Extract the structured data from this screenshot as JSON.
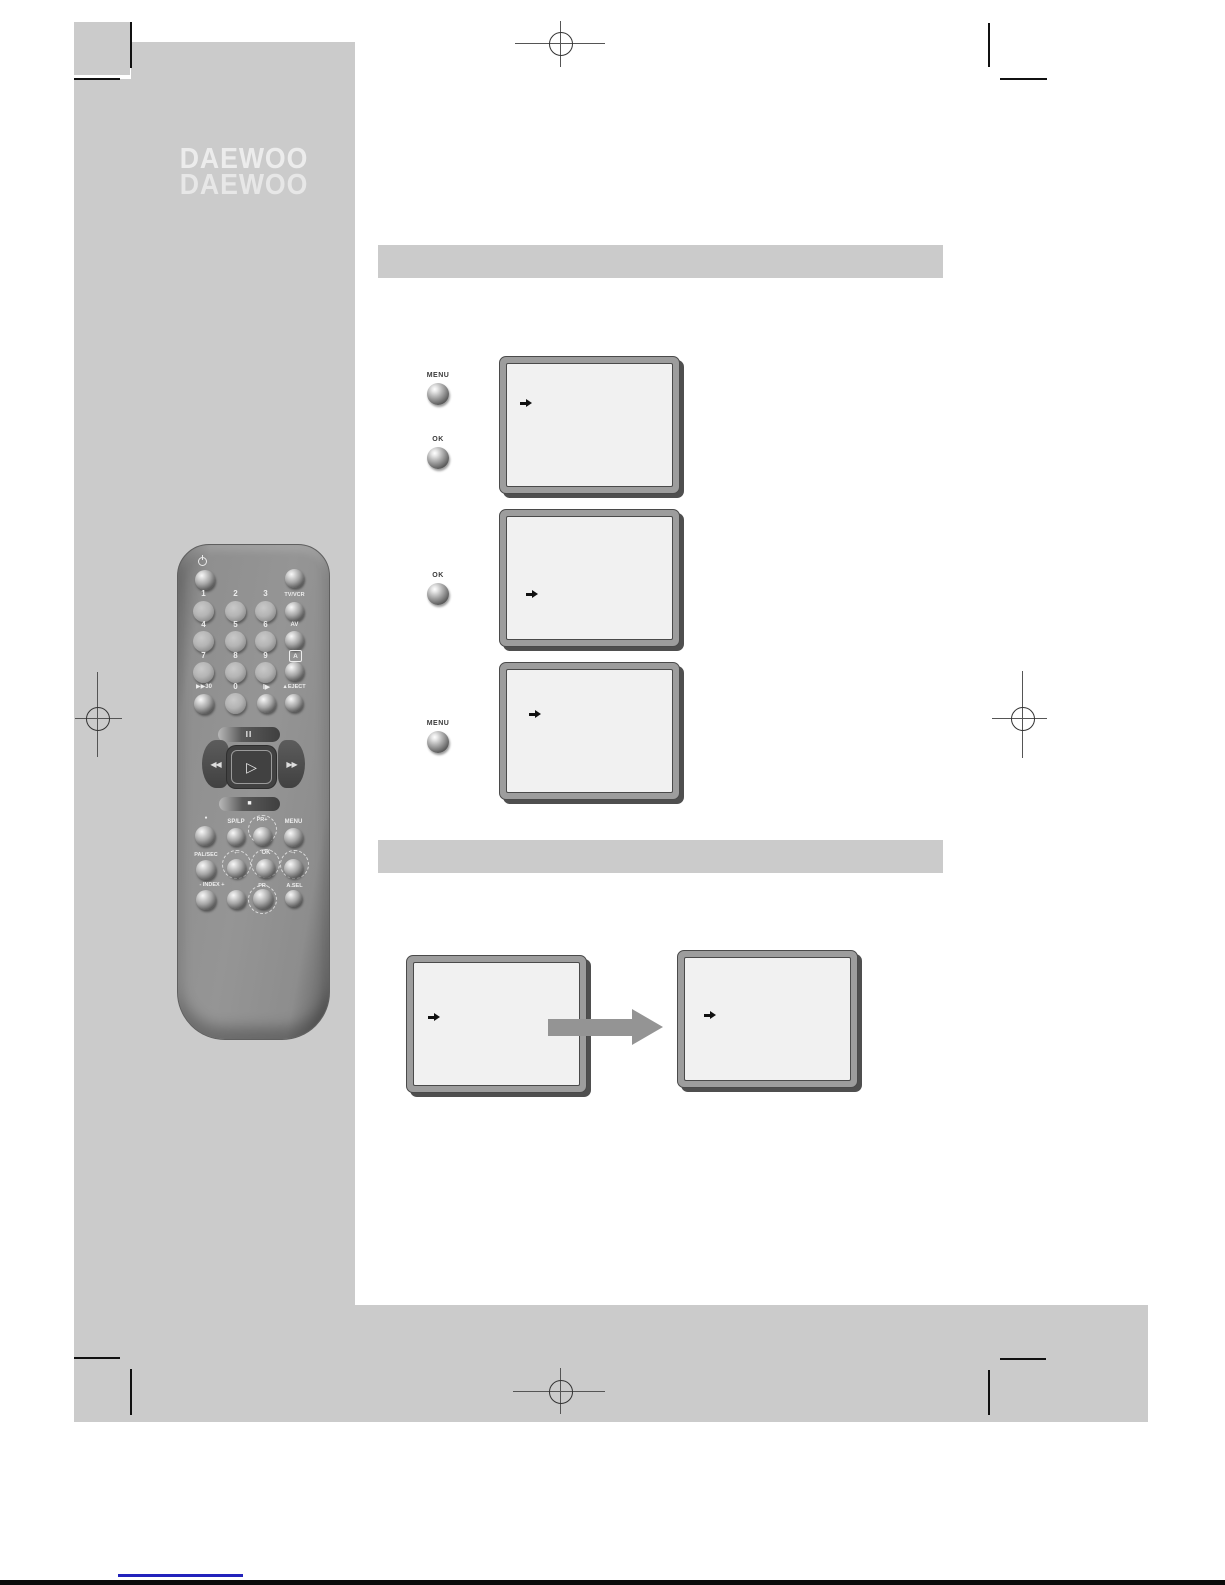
{
  "brand": {
    "name": "DAEWOO"
  },
  "instructions": {
    "buttons": [
      {
        "label": "MENU"
      },
      {
        "label": "OK"
      },
      {
        "label": "OK"
      },
      {
        "label": "MENU"
      }
    ]
  },
  "remote": {
    "digits": [
      "1",
      "2",
      "3",
      "4",
      "5",
      "6",
      "7",
      "8",
      "9"
    ],
    "row4": {
      "skip": "▶▶30",
      "zero": "0",
      "frame": "I▶"
    },
    "side": {
      "tvvcr": "TV/VCR",
      "av": "AV",
      "a": "A",
      "eject": "▲EJECT"
    },
    "transport": {
      "pause": "II",
      "rew": "◀◀",
      "play": "▷",
      "ffwd": "▶▶",
      "stop": "■"
    },
    "functions": {
      "record_dot": "●",
      "splp": "SP/LP",
      "pr_up": "PR+",
      "menu": "MENU",
      "palsec": "PAL/SEC",
      "left": "←",
      "ok": "OK",
      "right": "→",
      "index": "- INDEX +",
      "pr_down": "PR-",
      "asel": "A.SEL"
    }
  },
  "colors": {
    "sidebar_gray": "#cbcbcb",
    "section_bar_gray": "#cbcbcb",
    "screen_face": "#f1f1f1",
    "screen_frame": "#9d9d9d",
    "flow_arrow": "#949494",
    "footer_line_blue": "#2222bb",
    "footer_bar_black": "#0b0b0b"
  }
}
